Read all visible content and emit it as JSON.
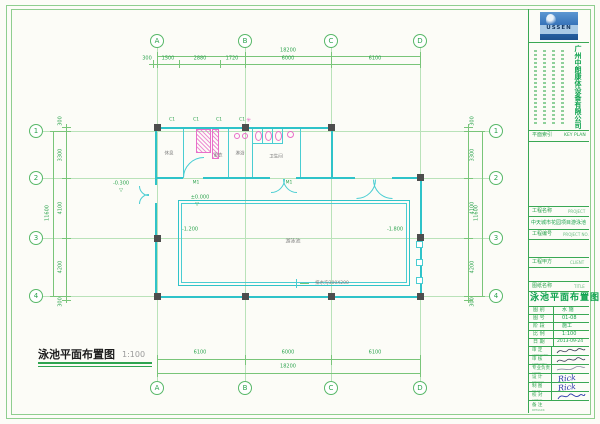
{
  "colors": {
    "line_green": "#79c579",
    "text_green": "#2ea44f",
    "wall_cyan": "#2fc3c9",
    "fixture_pink": "#e86ec9",
    "column_gray": "#4d4d4d",
    "logo_blue": "#2f6cb4",
    "sheet_title_green": "#0ea24e"
  },
  "plan": {
    "grid": {
      "cols": [
        "A",
        "B",
        "C",
        "D"
      ],
      "rows": [
        "1",
        "2",
        "3",
        "4"
      ]
    },
    "dims": {
      "top_total": "18200",
      "top_segments": [
        "300",
        "1500",
        "2880",
        "1720",
        "6000",
        "6100"
      ],
      "bottom_segments": [
        "6100",
        "6000",
        "6100"
      ],
      "bottom_total": "18200",
      "side_total": "11600",
      "side_segments": [
        "300",
        "3300",
        "4100",
        "4200",
        "300"
      ]
    },
    "rooms": [
      "休息",
      "更衣",
      "淋浴",
      "卫生间"
    ],
    "pool_label": "游泳池",
    "elevations": {
      "entrance_outside": "-0.300",
      "entrance_inside": "±0.000",
      "pool_shallow": "-1.200",
      "pool_deep": "-1.800"
    },
    "marker_glyph": "▽",
    "drain_note": "排水沟300X200",
    "tags": {
      "window": "C1",
      "door": "M1"
    }
  },
  "footer": {
    "title": "泳池平面布置图",
    "scale": "1:100"
  },
  "titleblock": {
    "logo_text": "USSEN",
    "company_name": "广州中朗康体设备有限公司",
    "keyplan_label": "平面索引",
    "keyplan_en": "KEY PLAN",
    "project_label": "工程名称",
    "project_en": "PROJECT",
    "project_name": "中天城市花园项目游泳池",
    "projno_label": "工程编号",
    "projno_en": "PROJECT NO.",
    "client_label": "工程甲方",
    "client_en": "CLIENT",
    "sheet_label": "图纸名称",
    "sheet_en": "TITLE",
    "sheet_title": "泳池平面布置图",
    "info_rows": [
      {
        "label": "图 别",
        "value": "水 施"
      },
      {
        "label": "图 号",
        "value": "01-08"
      },
      {
        "label": "阶 段",
        "value": "施工"
      },
      {
        "label": "比 例",
        "value": "1:100"
      },
      {
        "label": "日 期",
        "value": "2013-09-24"
      }
    ],
    "sign_rows": [
      {
        "label": "审 定",
        "en": "APPROVED",
        "sig_text": ""
      },
      {
        "label": "审 核",
        "en": "CHECKED",
        "sig_text": ""
      },
      {
        "label": "专业负责",
        "en": "CHIEF",
        "sig_text": ""
      },
      {
        "label": "设 计",
        "en": "DESIGN",
        "sig_text": "Rick"
      },
      {
        "label": "制 图",
        "en": "DRAW",
        "sig_text": "Rick"
      },
      {
        "label": "校 对",
        "en": "CHECK",
        "sig_text": ""
      },
      {
        "label": "备 注",
        "en": "REMARK",
        "sig_text": ""
      }
    ]
  }
}
